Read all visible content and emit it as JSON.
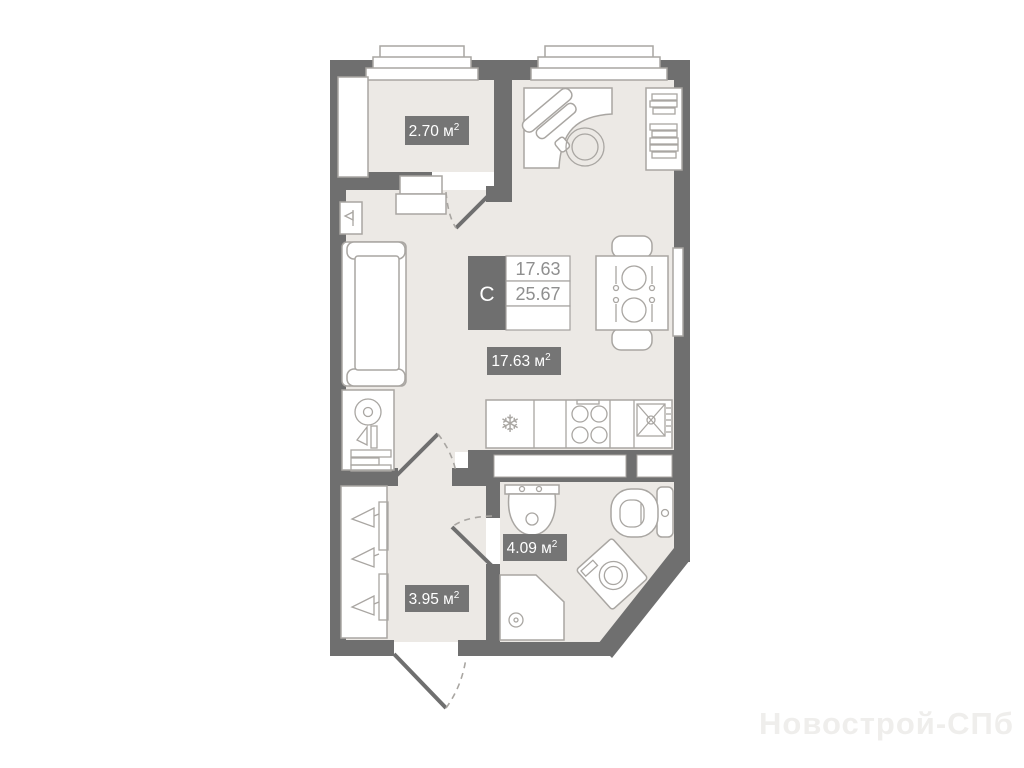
{
  "plan": {
    "type_label": "C",
    "stats": {
      "living_area": "17.63",
      "total_area": "25.67"
    },
    "rooms": {
      "balcony": {
        "area": "2.70"
      },
      "living": {
        "area": "17.63"
      },
      "bathroom": {
        "area": "4.09"
      },
      "hallway": {
        "area": "3.95"
      }
    },
    "unit": {
      "base": " м",
      "sup": "2"
    }
  },
  "icons": {
    "snowflake": "❄"
  },
  "watermark": {
    "text": "Новострой-СПб"
  },
  "colors": {
    "wall": "#6f6f6f",
    "floor": "#ece9e5",
    "badge": "#757575",
    "line": "#a9a6a2",
    "value": "#8f8f8f",
    "watermark": "#efeeec"
  }
}
